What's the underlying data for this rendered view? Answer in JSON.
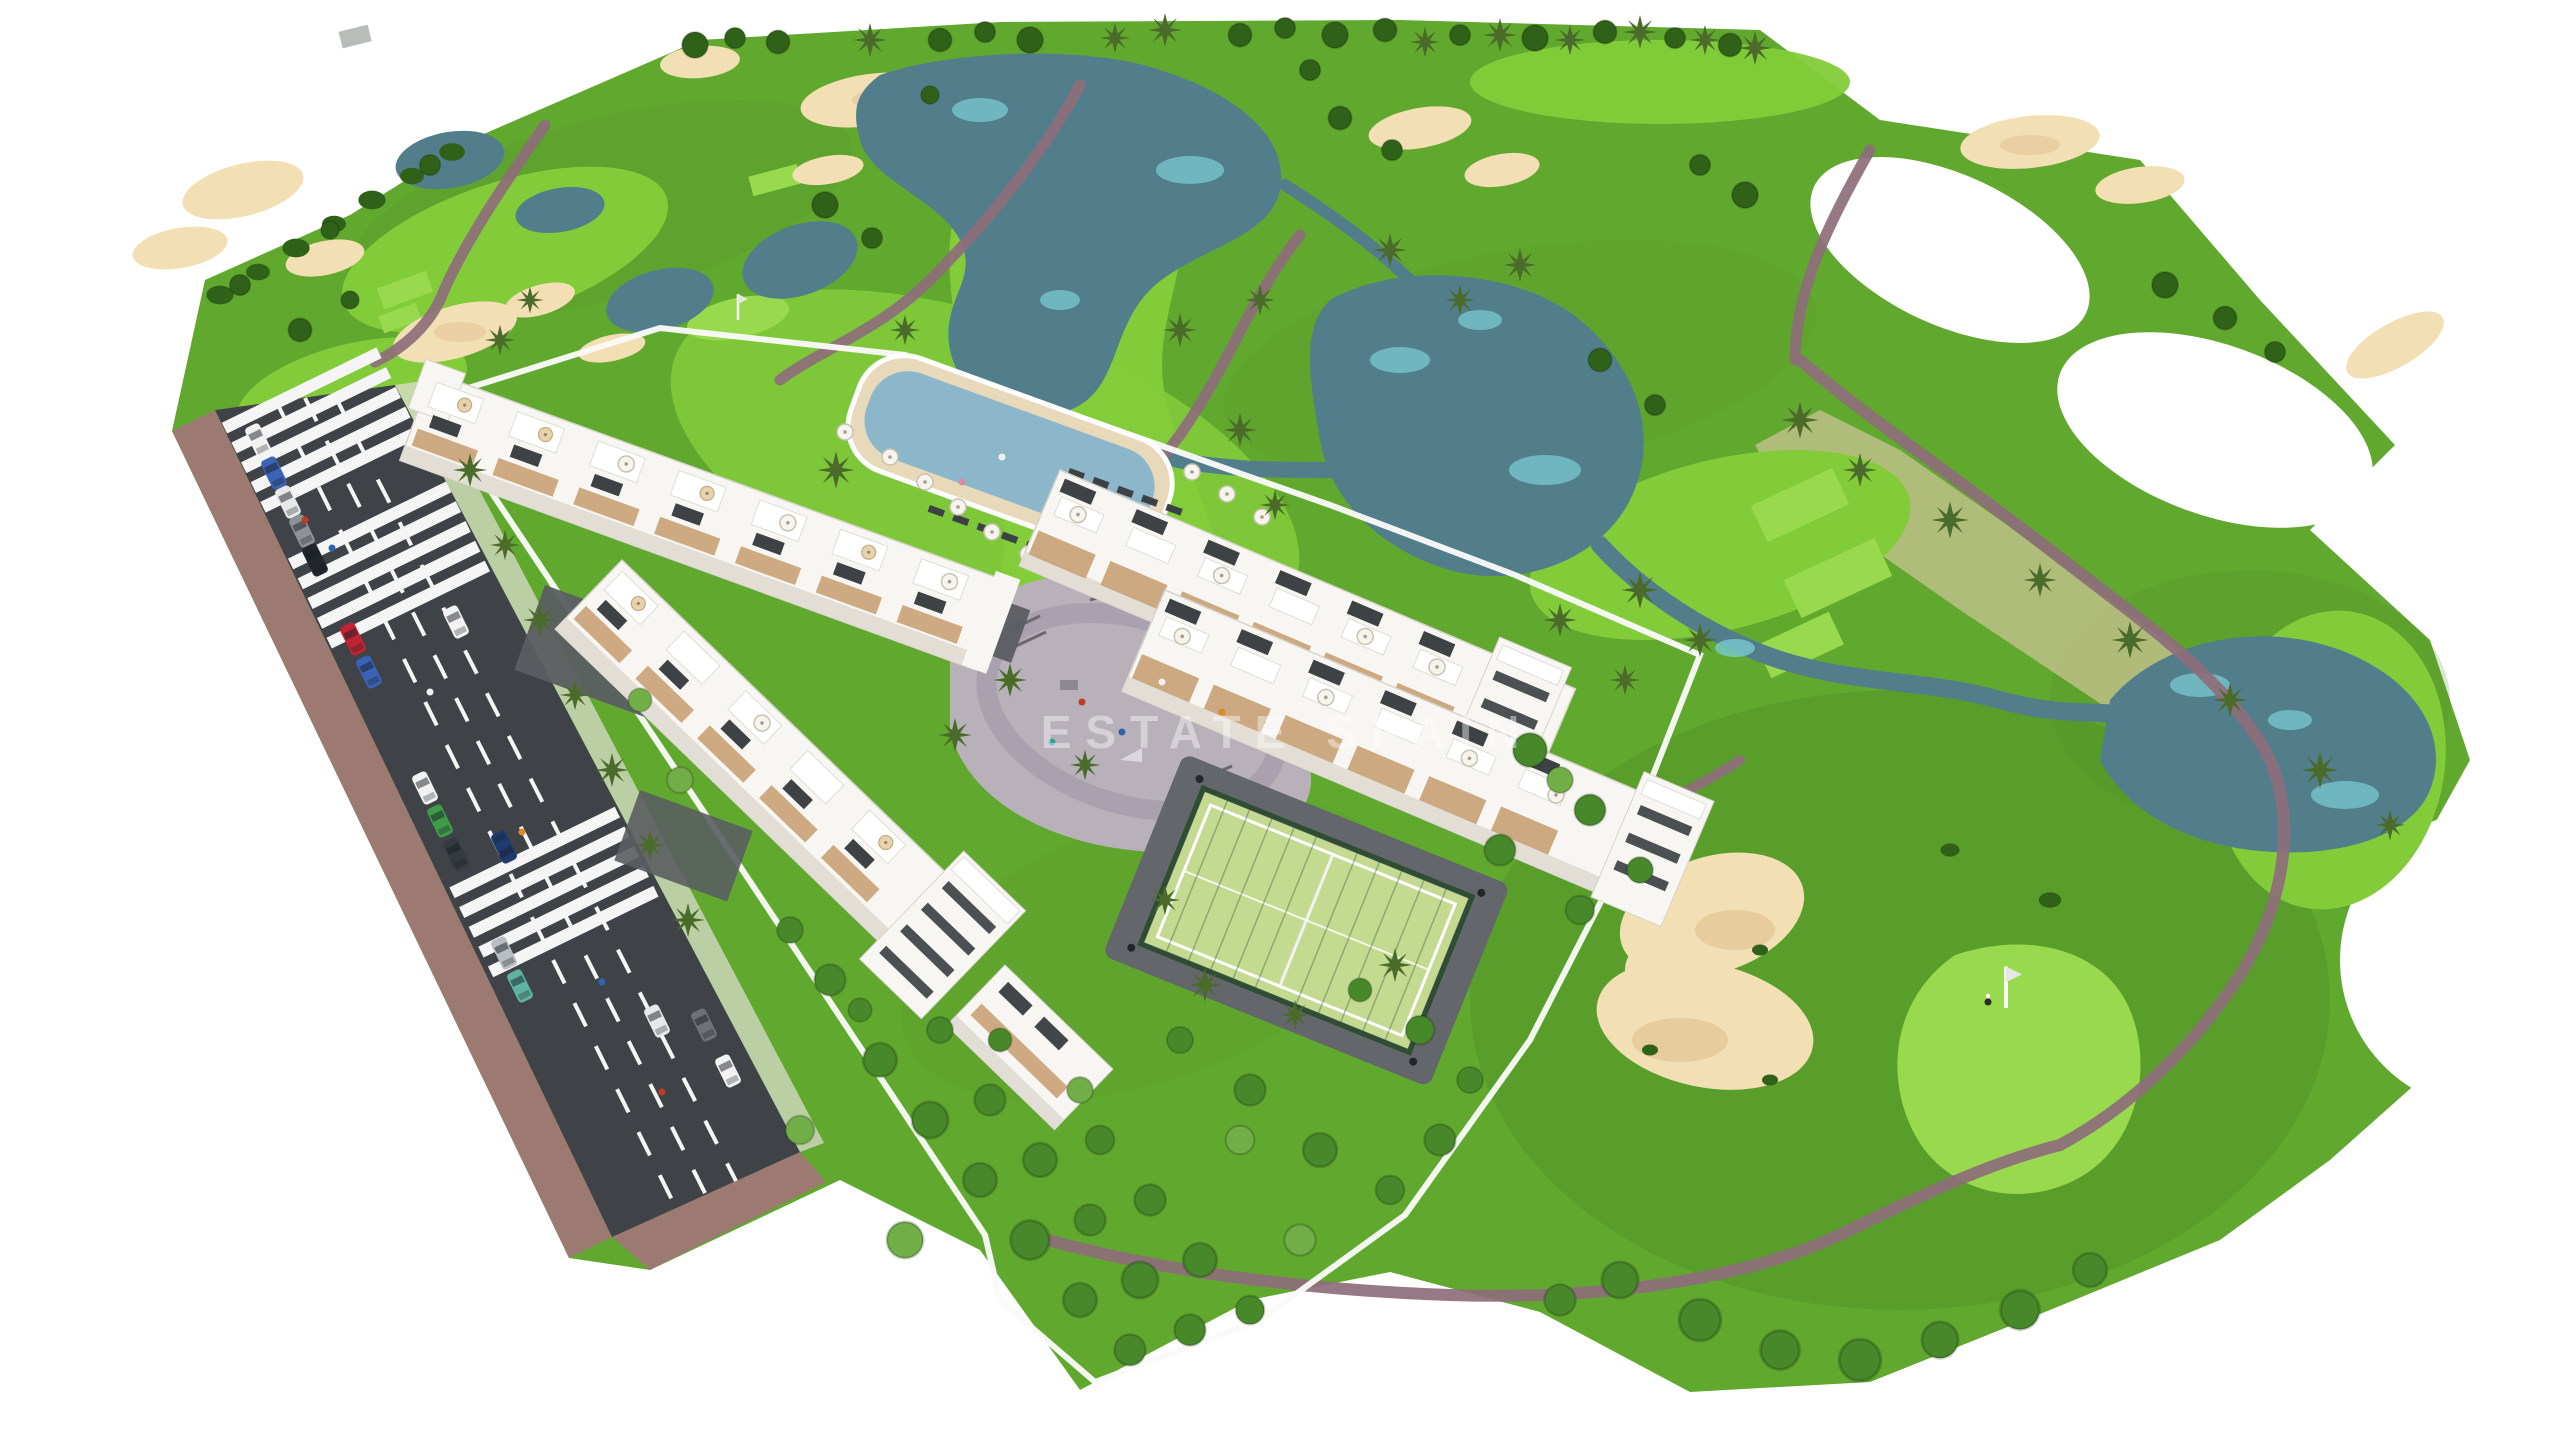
{
  "watermark": {
    "text": "ESTATE SPAIN"
  },
  "scene": {
    "title": "Aerial 3D render of a golf-resort residential development",
    "features": [
      "golf course with fairways and rough",
      "lakes and winding streams",
      "sand bunkers",
      "mauve cart paths",
      "putting green with flagstick and golfer",
      "golf buggy",
      "two white apartment blocks with rooftop terraces and solar panels",
      "two townhouse rows with pergolas and roof umbrellas",
      "communal swimming pool with sun umbrellas and loungers",
      "children playground plaza",
      "fenced padel court",
      "avenue with parked cars, lane markings and zebra crossings",
      "brick sidewalks",
      "white perimeter walls",
      "palm trees and gardens"
    ]
  },
  "colors": {
    "background": "#ffffff",
    "rough": "#61a82f",
    "rough_dark": "#4c8a24",
    "fairway": "#82cc39",
    "green_bright": "#98d94e",
    "scrub": "#b4bd7e",
    "tree_dark": "#2f6118",
    "tree_mid": "#47892a",
    "tree_light": "#71ae47",
    "palm": "#4a6b2a",
    "sand": "#f2dfb4",
    "sand_dark": "#dfc08e",
    "water": "#527e8c",
    "water_light": "#79c9cf",
    "path": "#8e6e7b",
    "road": "#3f4347",
    "road_mark": "#f5f5f5",
    "sidewalk": "#9c7a71",
    "drive": "#5a5d61",
    "pavement": "#b8b1ba",
    "pavement_path": "#a79fab",
    "wall": "#fafaf8",
    "building": "#f7f6f2",
    "building_shade": "#e2ded6",
    "window": "#2e3236",
    "wood": "#c8a276",
    "pool": "#8cb6c9",
    "deck": "#e9d9bb",
    "court": "#c3da90",
    "court_fence": "#2f4d33",
    "watermark": "#ffffff",
    "car_colors": [
      "#f2f2f2",
      "#3a62b5",
      "#e8e8e8",
      "#8d9296",
      "#20262b",
      "#c02432",
      "#3a62b5",
      "#f2f2f2",
      "#3f9b4a",
      "#343a40",
      "#b9bec2",
      "#5fb3a1",
      "#f2f2f2",
      "#1e3a6e",
      "#e8e8e8",
      "#6d7276",
      "#f2f2f2"
    ]
  }
}
